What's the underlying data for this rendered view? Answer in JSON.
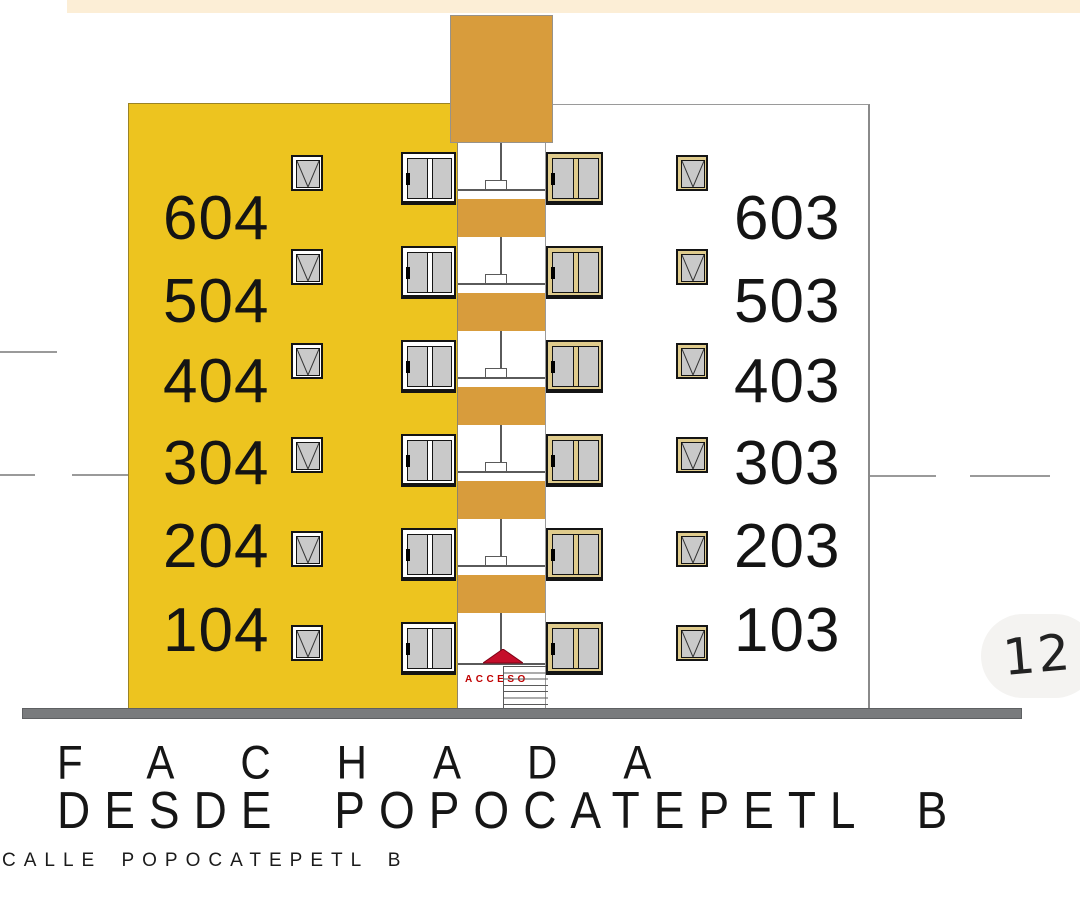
{
  "palette": {
    "facade_yellow": "#EDC41F",
    "tower_tan": "#D89C3C",
    "window_frame_tan": "#DFCB8C",
    "glass_gray": "#C9C9C9",
    "ground_gray": "#797B7D",
    "top_strip_cream": "#FCEED6",
    "accent_red": "#C50E2B"
  },
  "units": {
    "left": [
      "604",
      "504",
      "404",
      "304",
      "204",
      "104"
    ],
    "right": [
      "603",
      "503",
      "403",
      "303",
      "203",
      "103"
    ]
  },
  "labels": {
    "access": "ACCESO",
    "title_line1": "FACHADA",
    "title_line2": "DESDE POPOCATEPETL B",
    "street": "CALLE POPOCATEPETL B",
    "page_number": "12"
  }
}
